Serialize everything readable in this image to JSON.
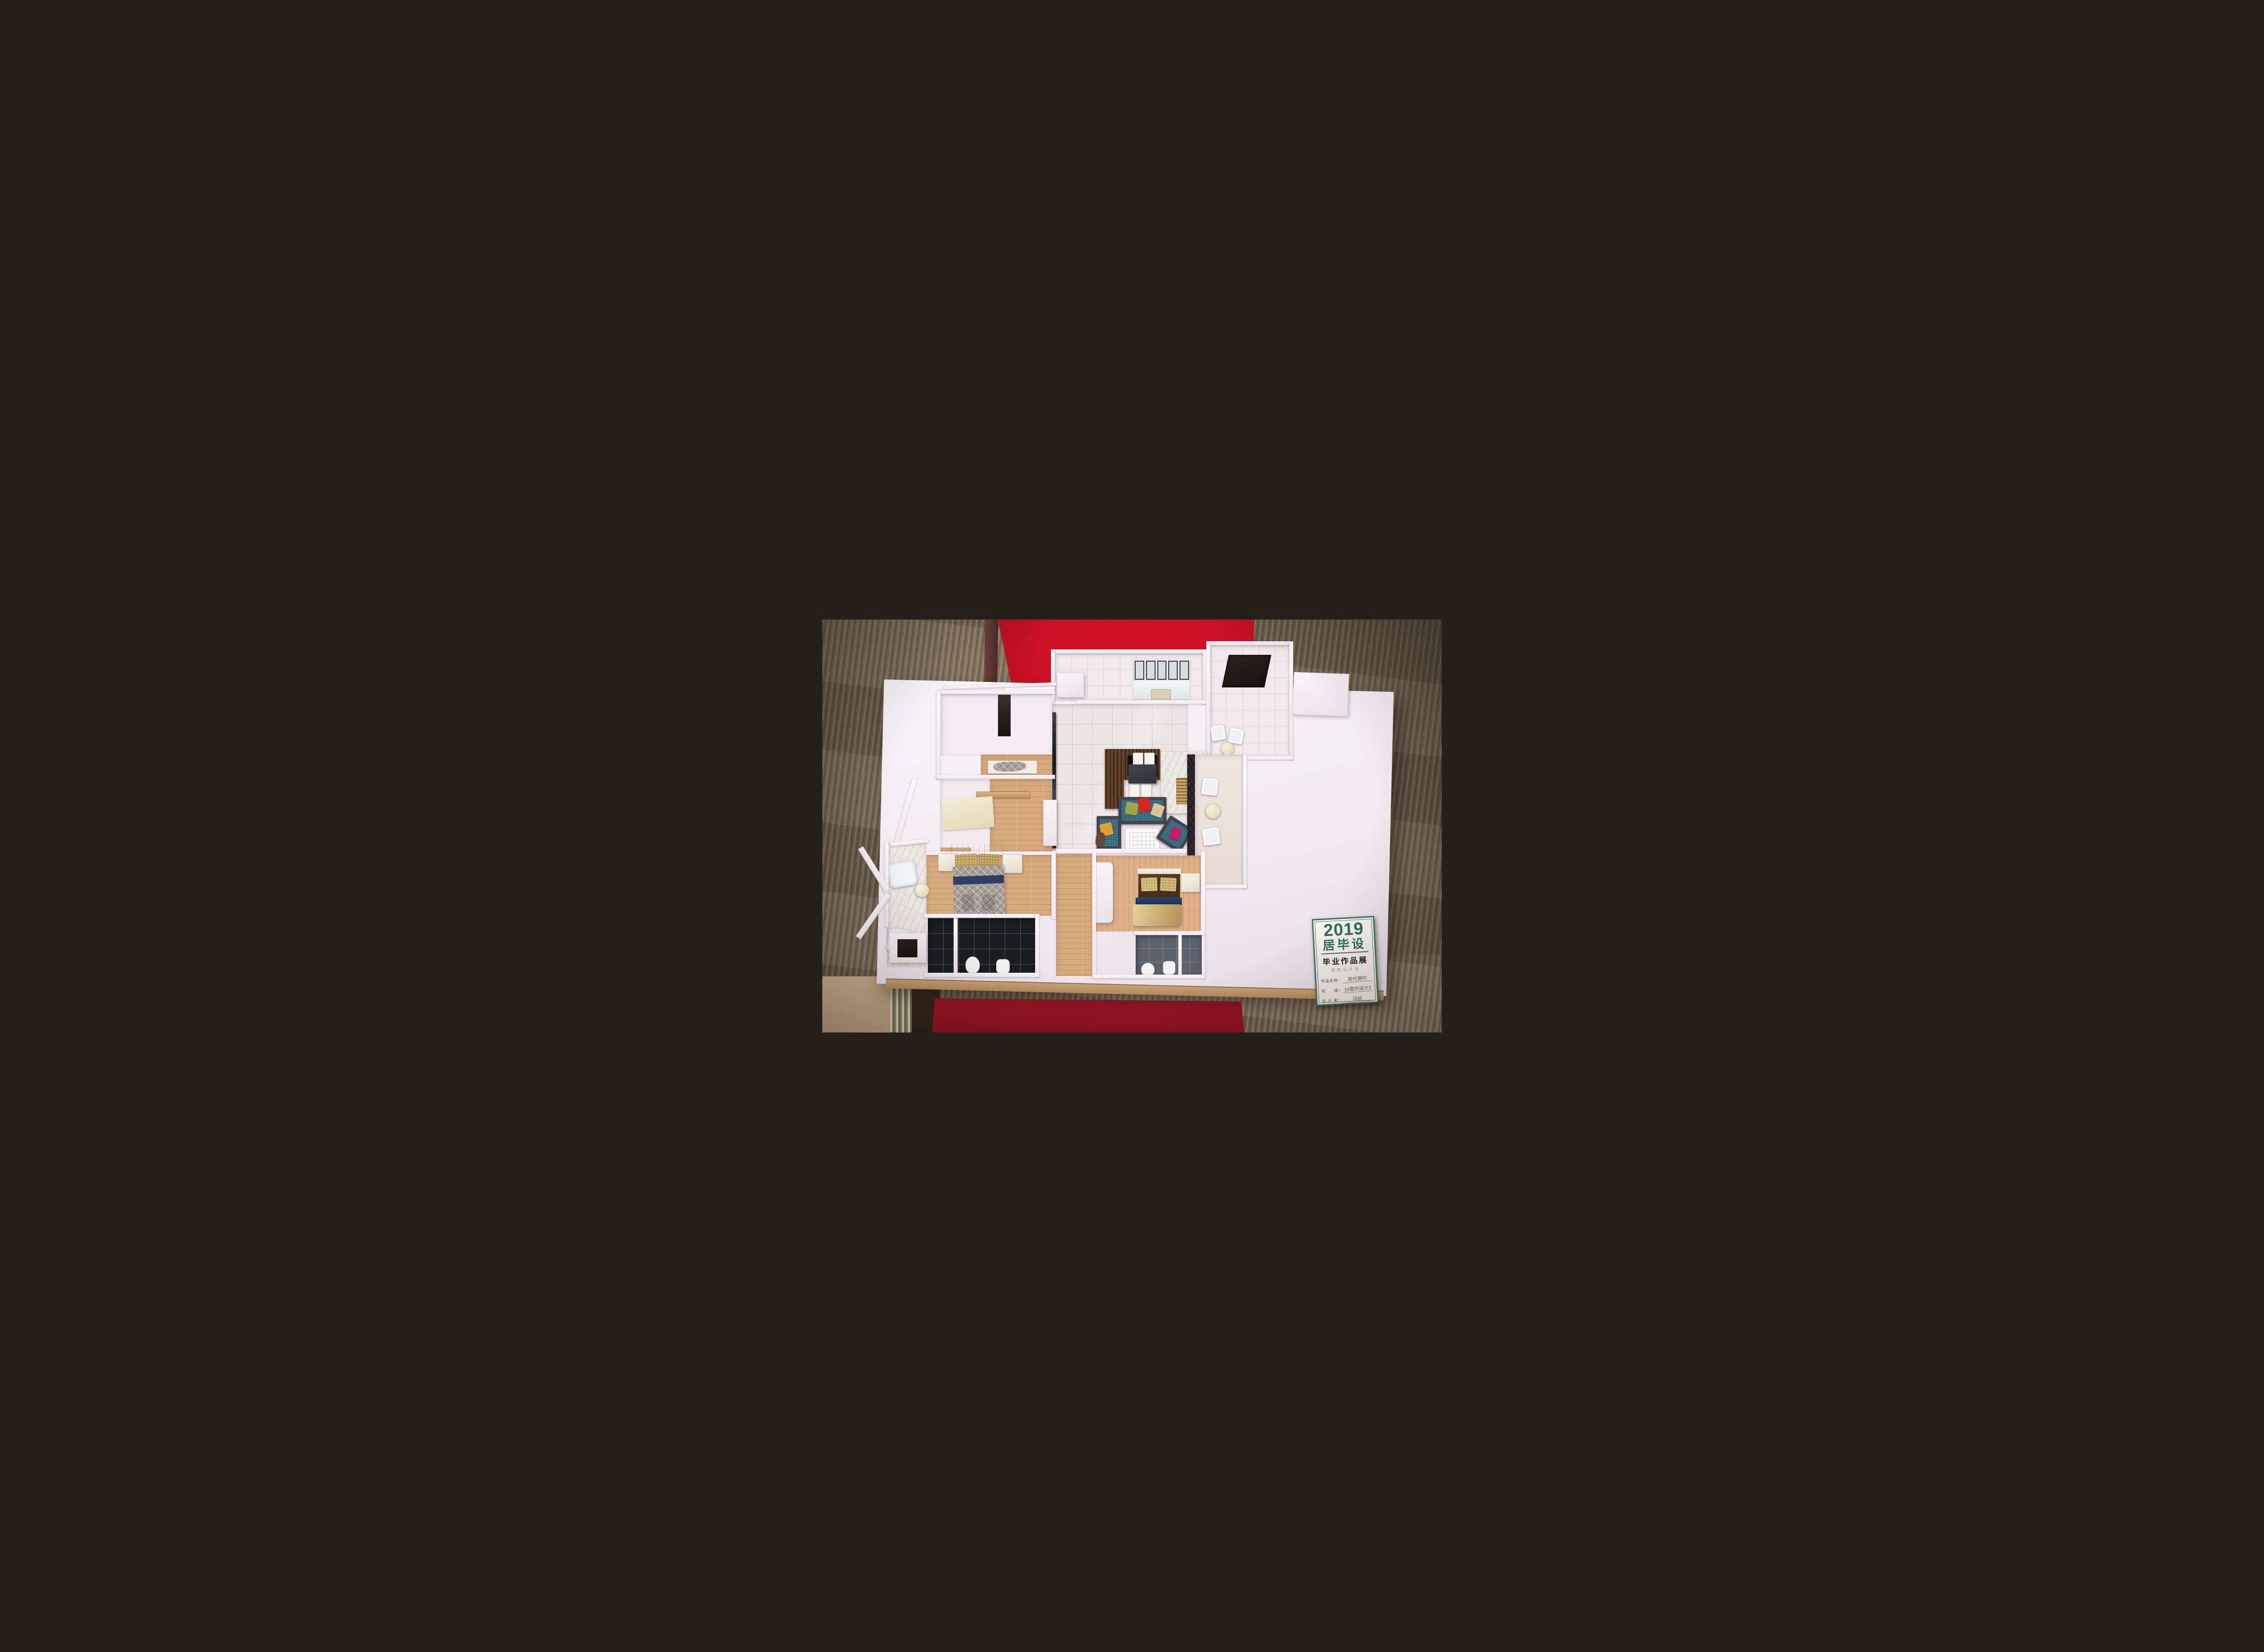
{
  "scene": {
    "kind": "photograph",
    "subject": "apartment floor-plan scale model on exhibition table",
    "rooms": [
      "kitchen",
      "living-dining-hall",
      "bedroom-top-left",
      "study-bedroom",
      "master-bedroom",
      "bedroom-2",
      "bathroom-black-tile",
      "bathroom-gray-tile",
      "bathroom-top-right",
      "balcony-right",
      "balcony-left-bay"
    ],
    "colors": {
      "carpet": "#7d6e59",
      "red_cloth_top": "#cf1126",
      "red_cloth_bottom": "#9e1526",
      "base_board": "#f4eff2",
      "base_edge": "#c49a6c",
      "wall": "#f6f1f4",
      "wood_floor": "#d8a97c",
      "tile_floor": "#ede4e6",
      "black_tile": "#1c1d21",
      "gray_tile": "#5b626c",
      "sofa_teal": "#2f6477",
      "sofa_frame": "#43474d",
      "pillow_red": "#d5271f",
      "pillow_olive": "#a3a24b",
      "pillow_cream": "#d8c49c",
      "pillow_yellow": "#e2a12f",
      "pillow_magenta": "#c51d62",
      "dining_table": "#3a3b40",
      "tv_wood": "#5e402b",
      "marble": "#ece8e4",
      "gold_vent": "#cda668",
      "quilt_gray": "#a8a199",
      "bed_navy": "#2e3f63",
      "bed_gold": "#c9b176",
      "headboard_brown": "#54391f"
    }
  },
  "label_card": {
    "year": "2019",
    "title": "居毕设",
    "subtitle": "毕业作品展",
    "department": "建筑设计系",
    "fields": [
      {
        "label": "作品名称：",
        "value": "现代简约"
      },
      {
        "label": "班　　级：",
        "value": "16室内设计2"
      },
      {
        "label": "设 计 者：",
        "value": "闫丝"
      }
    ],
    "footer": "· · · · · · · ·",
    "accent_color": "#2f6d5f",
    "department_color": "#d08a5f"
  }
}
